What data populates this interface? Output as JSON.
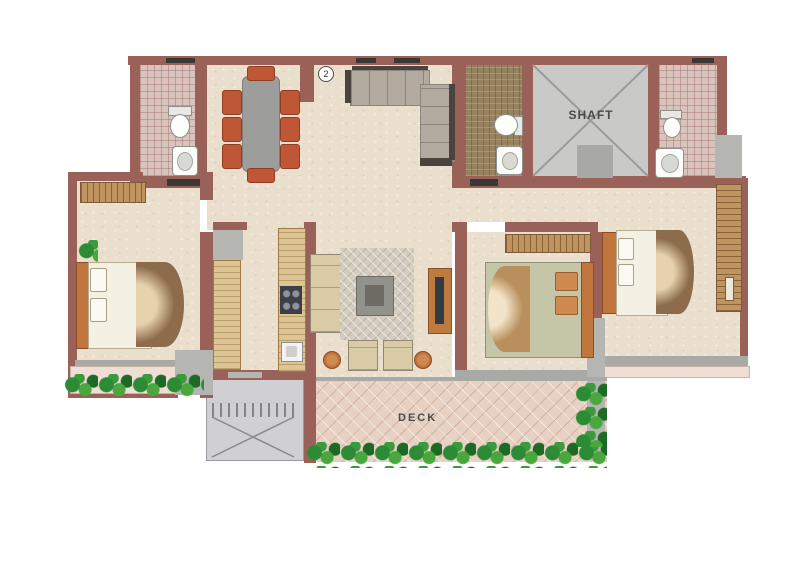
{
  "labels": {
    "shaft": "SHAFT",
    "deck": "DECK",
    "entry_number": "2"
  },
  "palette": {
    "wall": "#9a6158",
    "floor": "#eadfcd",
    "bath_tile_pink": "#d9c4bd",
    "bath_tile_brown": "#97825f",
    "shaft_gray": "#c9c9c7",
    "deck_tile": "#e7d1c3",
    "chair_orange": "#bf5636",
    "wood": "#c0945e",
    "greenery": "#2c8c35"
  }
}
